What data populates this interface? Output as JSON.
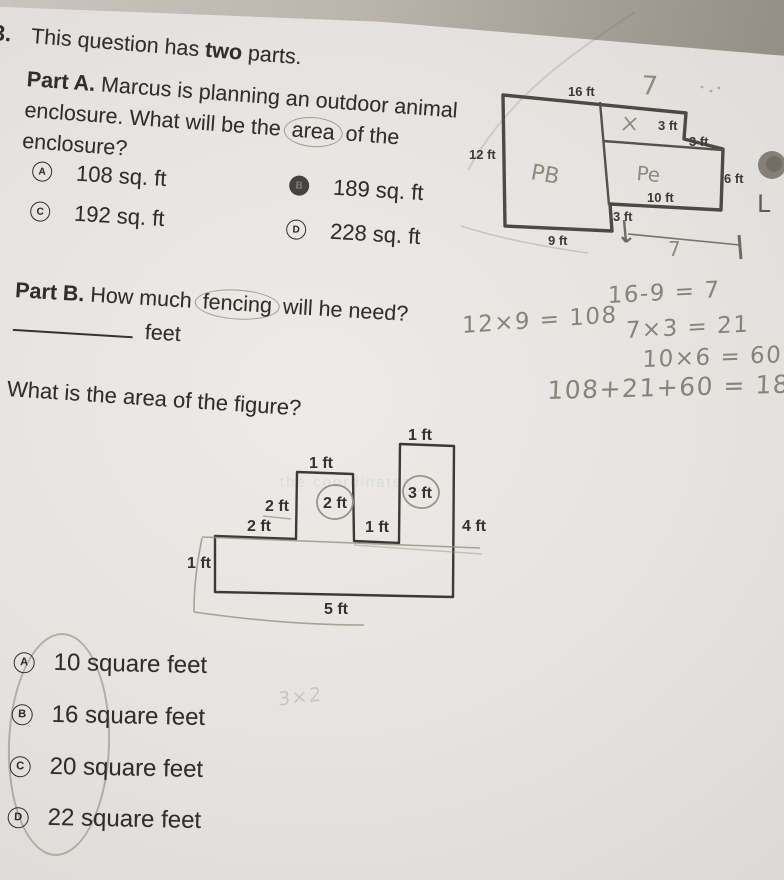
{
  "header": {
    "question_number": "3.",
    "intro_pre": "This question has ",
    "intro_bold": "two",
    "intro_post": " parts."
  },
  "part_a": {
    "label": "Part A.",
    "text_pre": " Marcus is planning an outdoor animal enclosure. What will be the ",
    "circled_word": "area",
    "text_post": " of the enclosure?",
    "options": [
      {
        "letter": "A",
        "text": "108 sq. ft",
        "selected": false
      },
      {
        "letter": "B",
        "text": "189 sq. ft",
        "selected": true
      },
      {
        "letter": "C",
        "text": "192 sq. ft",
        "selected": false
      },
      {
        "letter": "D",
        "text": "228 sq. ft",
        "selected": false
      }
    ]
  },
  "enclosure_diagram": {
    "dims": {
      "top": "16 ft",
      "left": "12 ft",
      "inner_top": "3 ft",
      "right_step": "3 ft",
      "right_side": "6 ft",
      "right_bottom": "10 ft",
      "bottom_step": "3 ft",
      "bottom": "9 ft"
    },
    "handwriting": {
      "top_width": "7",
      "bottom_width": "7",
      "left_room_scribble": "PB",
      "right_room_scribble": "Pe",
      "pen_mark": "L"
    }
  },
  "part_b": {
    "label": "Part B.",
    "text_pre": " How much ",
    "circled_word": "fencing",
    "text_post": " will he need?",
    "answer_unit": "feet"
  },
  "student_work": {
    "lines": [
      "16-9 = 7",
      "12×9 = 108",
      "7×3 = 21",
      "10×6 = 60",
      "108+21+60 = 189"
    ],
    "faint_scribble": "3×2"
  },
  "area_question": {
    "prompt": "What is the area of the figure?",
    "options": [
      {
        "letter": "A",
        "text": "10 square feet"
      },
      {
        "letter": "B",
        "text": "16 square feet"
      },
      {
        "letter": "C",
        "text": "20 square feet"
      },
      {
        "letter": "D",
        "text": "22 square feet"
      }
    ]
  },
  "figure_diagram": {
    "dims": {
      "right_tower_top": "1 ft",
      "left_tower_top": "1 ft",
      "left_tower_side": "2 ft",
      "left_tower_inner": "2 ft",
      "right_tower_inner": "3 ft",
      "base_top_left": "2 ft",
      "between_towers": "1 ft",
      "right_side": "4 ft",
      "base_left": "1 ft",
      "base_bottom": "5 ft"
    }
  },
  "ghost": {
    "bleed_text": "the coordinates"
  }
}
